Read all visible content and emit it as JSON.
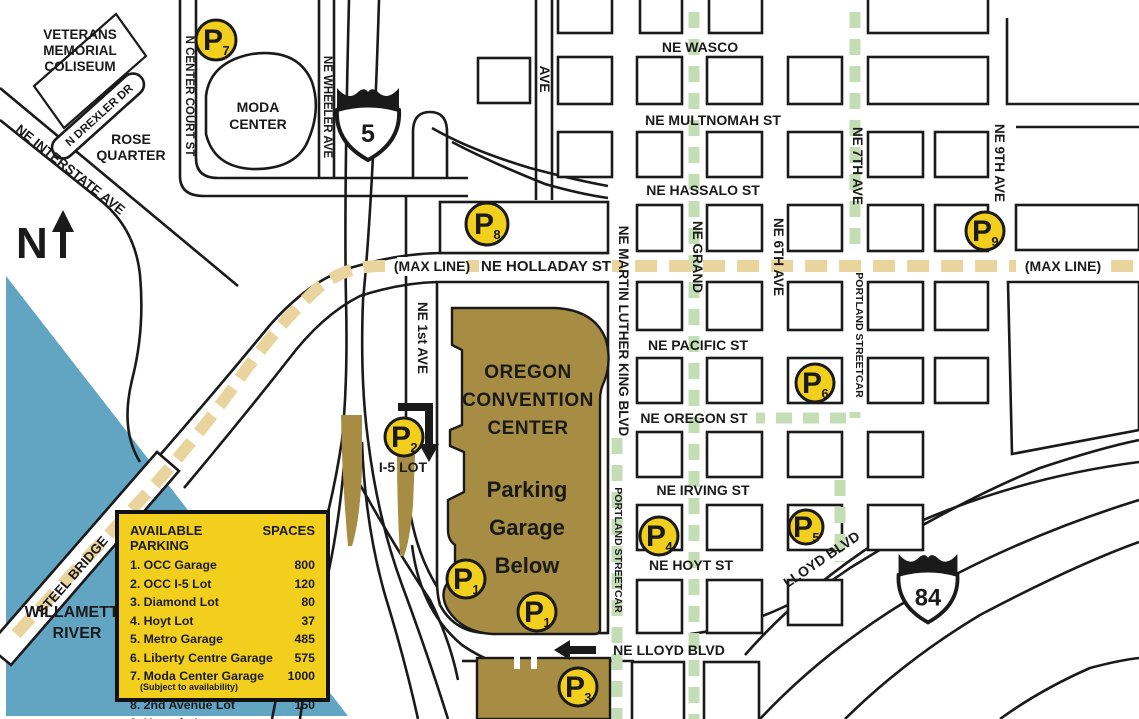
{
  "compass": {
    "letter": "N"
  },
  "shields": {
    "i5": "5",
    "i84": "84"
  },
  "places": {
    "veterans": [
      "VETERANS",
      "MEMORIAL",
      "COLISEUM"
    ],
    "rose_quarter": [
      "ROSE",
      "QUARTER"
    ],
    "moda": [
      "MODA",
      "CENTER"
    ],
    "occ": [
      "OREGON",
      "CONVENTION",
      "CENTER"
    ],
    "garage": [
      "Parking",
      "Garage",
      "Below"
    ],
    "river": [
      "WILLAMETTE",
      "RIVER"
    ],
    "steel_bridge": "STEEL BRIDGE",
    "i5_lot": "I-5 LOT"
  },
  "streets": {
    "interstate": "NE INTERSTATE AVE",
    "drexler": "N DREXLER DR",
    "center_court": "N CENTER COURT ST",
    "wheeler": "NE WHEELER AVE",
    "ave": "AVE",
    "first": "NE 1st AVE",
    "wasco": "NE WASCO",
    "multnomah": "NE MULTNOMAH ST",
    "hassalo": "NE HASSALO ST",
    "holladay": "NE HOLLADAY ST",
    "max_left": "(MAX LINE)",
    "max_right": "(MAX LINE)",
    "mlk": "NE MARTIN LUTHER KING BLVD",
    "grand": "NE GRAND",
    "sixth": "NE 6TH AVE",
    "seventh": "NE 7TH AVE",
    "ninth": "NE 9TH AVE",
    "pacific": "NE PACIFIC ST",
    "oregon": "NE OREGON ST",
    "irving": "NE IRVING ST",
    "hoyt": "NE HOYT ST",
    "lloyd": "NE LLOYD BLVD",
    "lloyd_diag": "LLOYD BLVD",
    "streetcar_7th": "PORTLAND STREETCAR",
    "streetcar_mlk": "PORTLAND STREETCAR"
  },
  "markers": {
    "p1a": {
      "letter": "P",
      "sub": "1"
    },
    "p1b": {
      "letter": "P",
      "sub": "1"
    },
    "p2": {
      "letter": "P",
      "sub": "2"
    },
    "p3": {
      "letter": "P",
      "sub": "3"
    },
    "p4": {
      "letter": "P",
      "sub": "4"
    },
    "p5": {
      "letter": "P",
      "sub": "5"
    },
    "p6": {
      "letter": "P",
      "sub": "6"
    },
    "p7": {
      "letter": "P",
      "sub": "7"
    },
    "p8": {
      "letter": "P",
      "sub": "8"
    },
    "p9": {
      "letter": "P",
      "sub": "9"
    }
  },
  "legend": {
    "title": "AVAILABLE PARKING",
    "spaces_header": "SPACES",
    "rows": [
      {
        "name": "1. OCC Garage",
        "spaces": "800"
      },
      {
        "name": "2. OCC I-5 Lot",
        "spaces": "120"
      },
      {
        "name": "3. Diamond Lot",
        "spaces": "80"
      },
      {
        "name": "4. Hoyt Lot",
        "spaces": "37"
      },
      {
        "name": "5. Metro Garage",
        "spaces": "485"
      },
      {
        "name": "6. Liberty Centre Garage",
        "spaces": "575"
      },
      {
        "name": "7. Moda Center Garage",
        "note": "(Subject to availability)",
        "spaces": "1000"
      },
      {
        "name": "8. 2nd Avenue Lot",
        "spaces": "150"
      },
      {
        "name": "9. Hassalo Lot",
        "spaces": ""
      }
    ]
  },
  "colors": {
    "parking_yellow": "#F2CF1D",
    "occ_brown": "#A78C43",
    "river_blue": "#62A5C3",
    "max_tan": "#EAD49E",
    "streetcar_green": "#C3DEB5",
    "line_black": "#1A1A1A"
  }
}
